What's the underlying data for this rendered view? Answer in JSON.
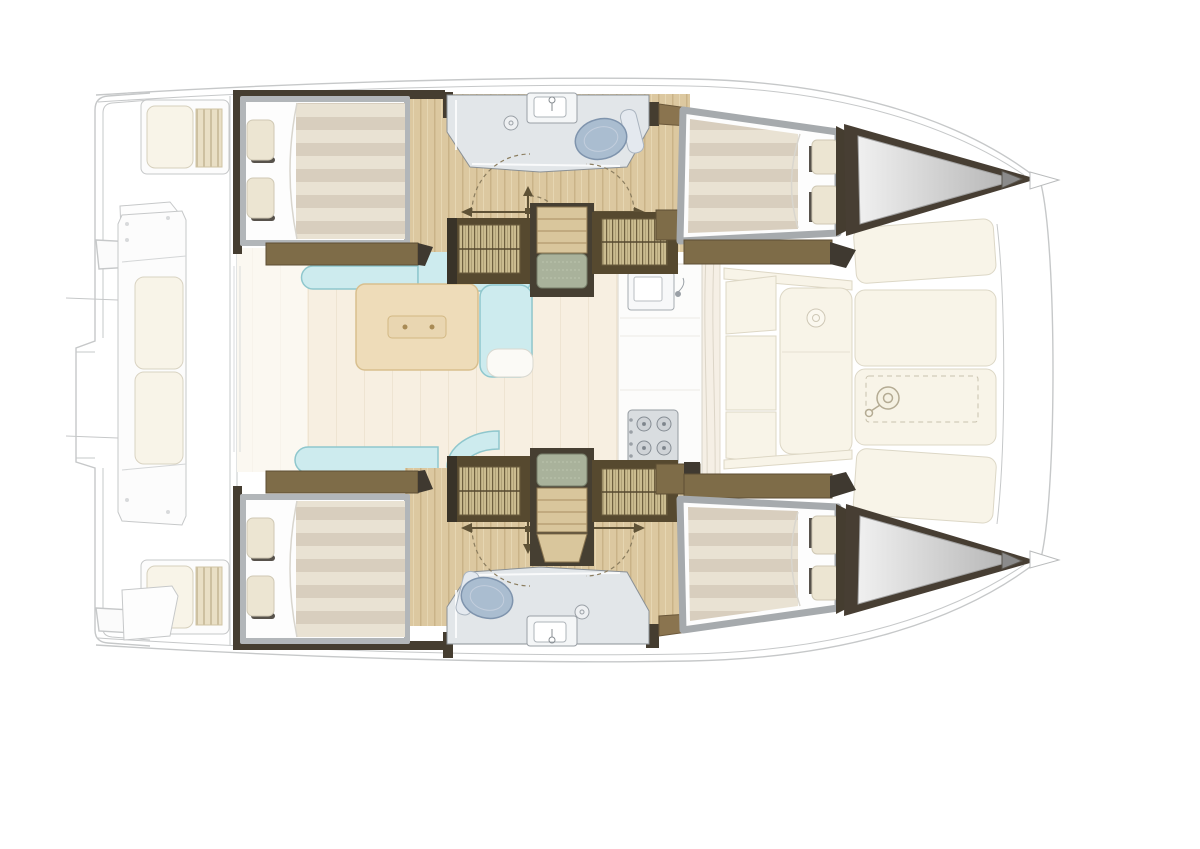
{
  "diagram": {
    "kind": "catamaran-floor-plan",
    "view": "top-down",
    "bow_direction": "right",
    "hulls": 2
  },
  "inventory": {
    "double_beds": 4,
    "bathrooms": 2,
    "toilets": 2,
    "sinks": 3,
    "stairways": 2,
    "louvered_wardrobes": 4,
    "salon_tables": 1,
    "sofa_sections": 5,
    "stove_burners": 4,
    "deck_cushion_panels": 4,
    "windlass_hatches": 1
  },
  "colors": {
    "background": "#ffffff",
    "hull_wood_floor": "#dcc8a0",
    "salon_floor": "#f7efe1",
    "sofa": "#cdebee",
    "sofa_edge": "#8fc7cd",
    "table": "#eedcb9",
    "table_edge": "#d8bf8e",
    "dark_bulkhead": "#453d30",
    "furniture_brown": "#7e6c48",
    "furniture_brown_edge": "#5d4e33",
    "wardrobe_frame": "#56492f",
    "wardrobe_louver": "#cbbc90",
    "stair_mat": "#a9b29b",
    "stair_wood": "#d9c69c",
    "bed_frame": "#b2b6b9",
    "mattress_light": "#e9e2d3",
    "mattress_dark": "#d8cebe",
    "pillow": "#ece5d2",
    "pillow_shadow": "#57524b",
    "bathroom_floor": "#e2e6e9",
    "bathroom_edge": "#8b9196",
    "toilet": "#aabdd0",
    "toilet_edge": "#7f94ad",
    "deck_cushion": "#f8f4e8",
    "deck_cushion_edge": "#d9d3c2",
    "stove": "#d9dde0",
    "ghost_outline": "#c6c8c9",
    "bow_locker_frame": "#473e33",
    "bow_locker_gray": "#c6c6c6",
    "door_symbol": "#5f5236"
  },
  "regions": [
    "aft-cockpit",
    "salon",
    "galley",
    "forward-cockpit",
    "foredeck",
    "upper-hull-aft-cabin",
    "upper-hull-bathroom",
    "upper-hull-stairs",
    "upper-hull-forward-cabin",
    "upper-bow-locker",
    "lower-hull-aft-cabin",
    "lower-hull-bathroom",
    "lower-hull-stairs",
    "lower-hull-forward-cabin",
    "lower-bow-locker"
  ],
  "icons": [
    "toilet-icon",
    "sink-icon",
    "faucet-icon",
    "shower-icon",
    "stove-burner-icon",
    "windlass-icon",
    "door-swing-icon"
  ]
}
